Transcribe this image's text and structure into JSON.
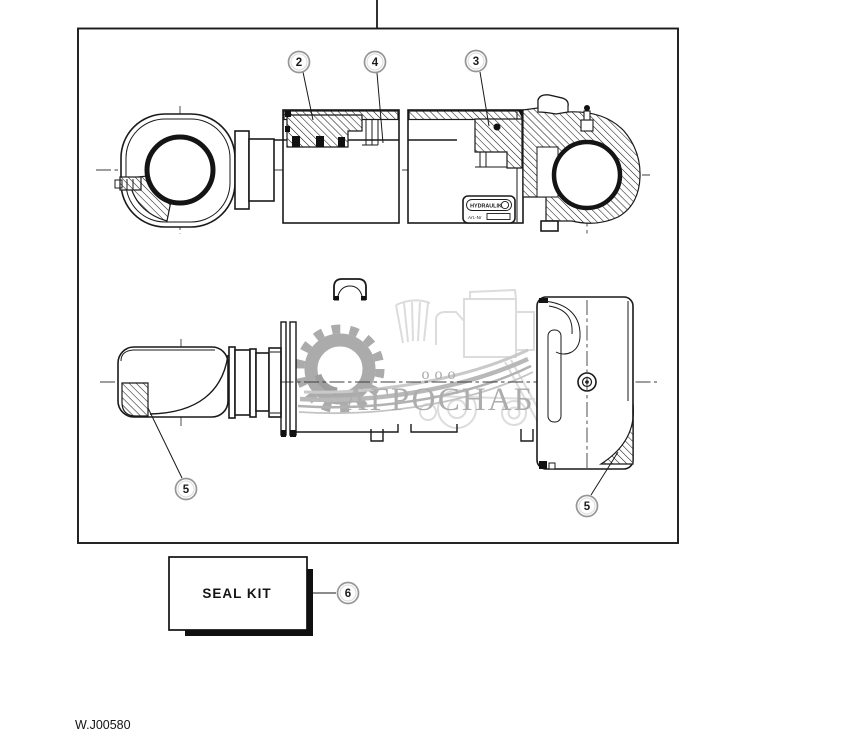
{
  "diagram": {
    "drawing_number": "W.J00580",
    "callouts": [
      {
        "label": "2",
        "target": "rod-gland-seal"
      },
      {
        "label": "4",
        "target": "piston-rod"
      },
      {
        "label": "3",
        "target": "head-gland-seal"
      },
      {
        "label": "5",
        "target": "rod-eye-bushing"
      },
      {
        "label": "5",
        "target": "base-eye-bushing"
      },
      {
        "label": "6",
        "target": "seal-kit"
      }
    ],
    "seal_kit_label": "SEAL KIT",
    "nameplate": {
      "brand": "HYDRAULIK",
      "art_label": "Art.-Nr"
    }
  },
  "watermark": {
    "org_form": "ооо",
    "company": "АГРОСНАБ"
  },
  "colors": {
    "background": "#ffffff",
    "line": "#1a1a1a",
    "callout_ring": "#969696",
    "watermark_text": "#adadad",
    "watermark_gear": "#a6a6a6",
    "watermark_silhouette": "#dcdcdc"
  }
}
